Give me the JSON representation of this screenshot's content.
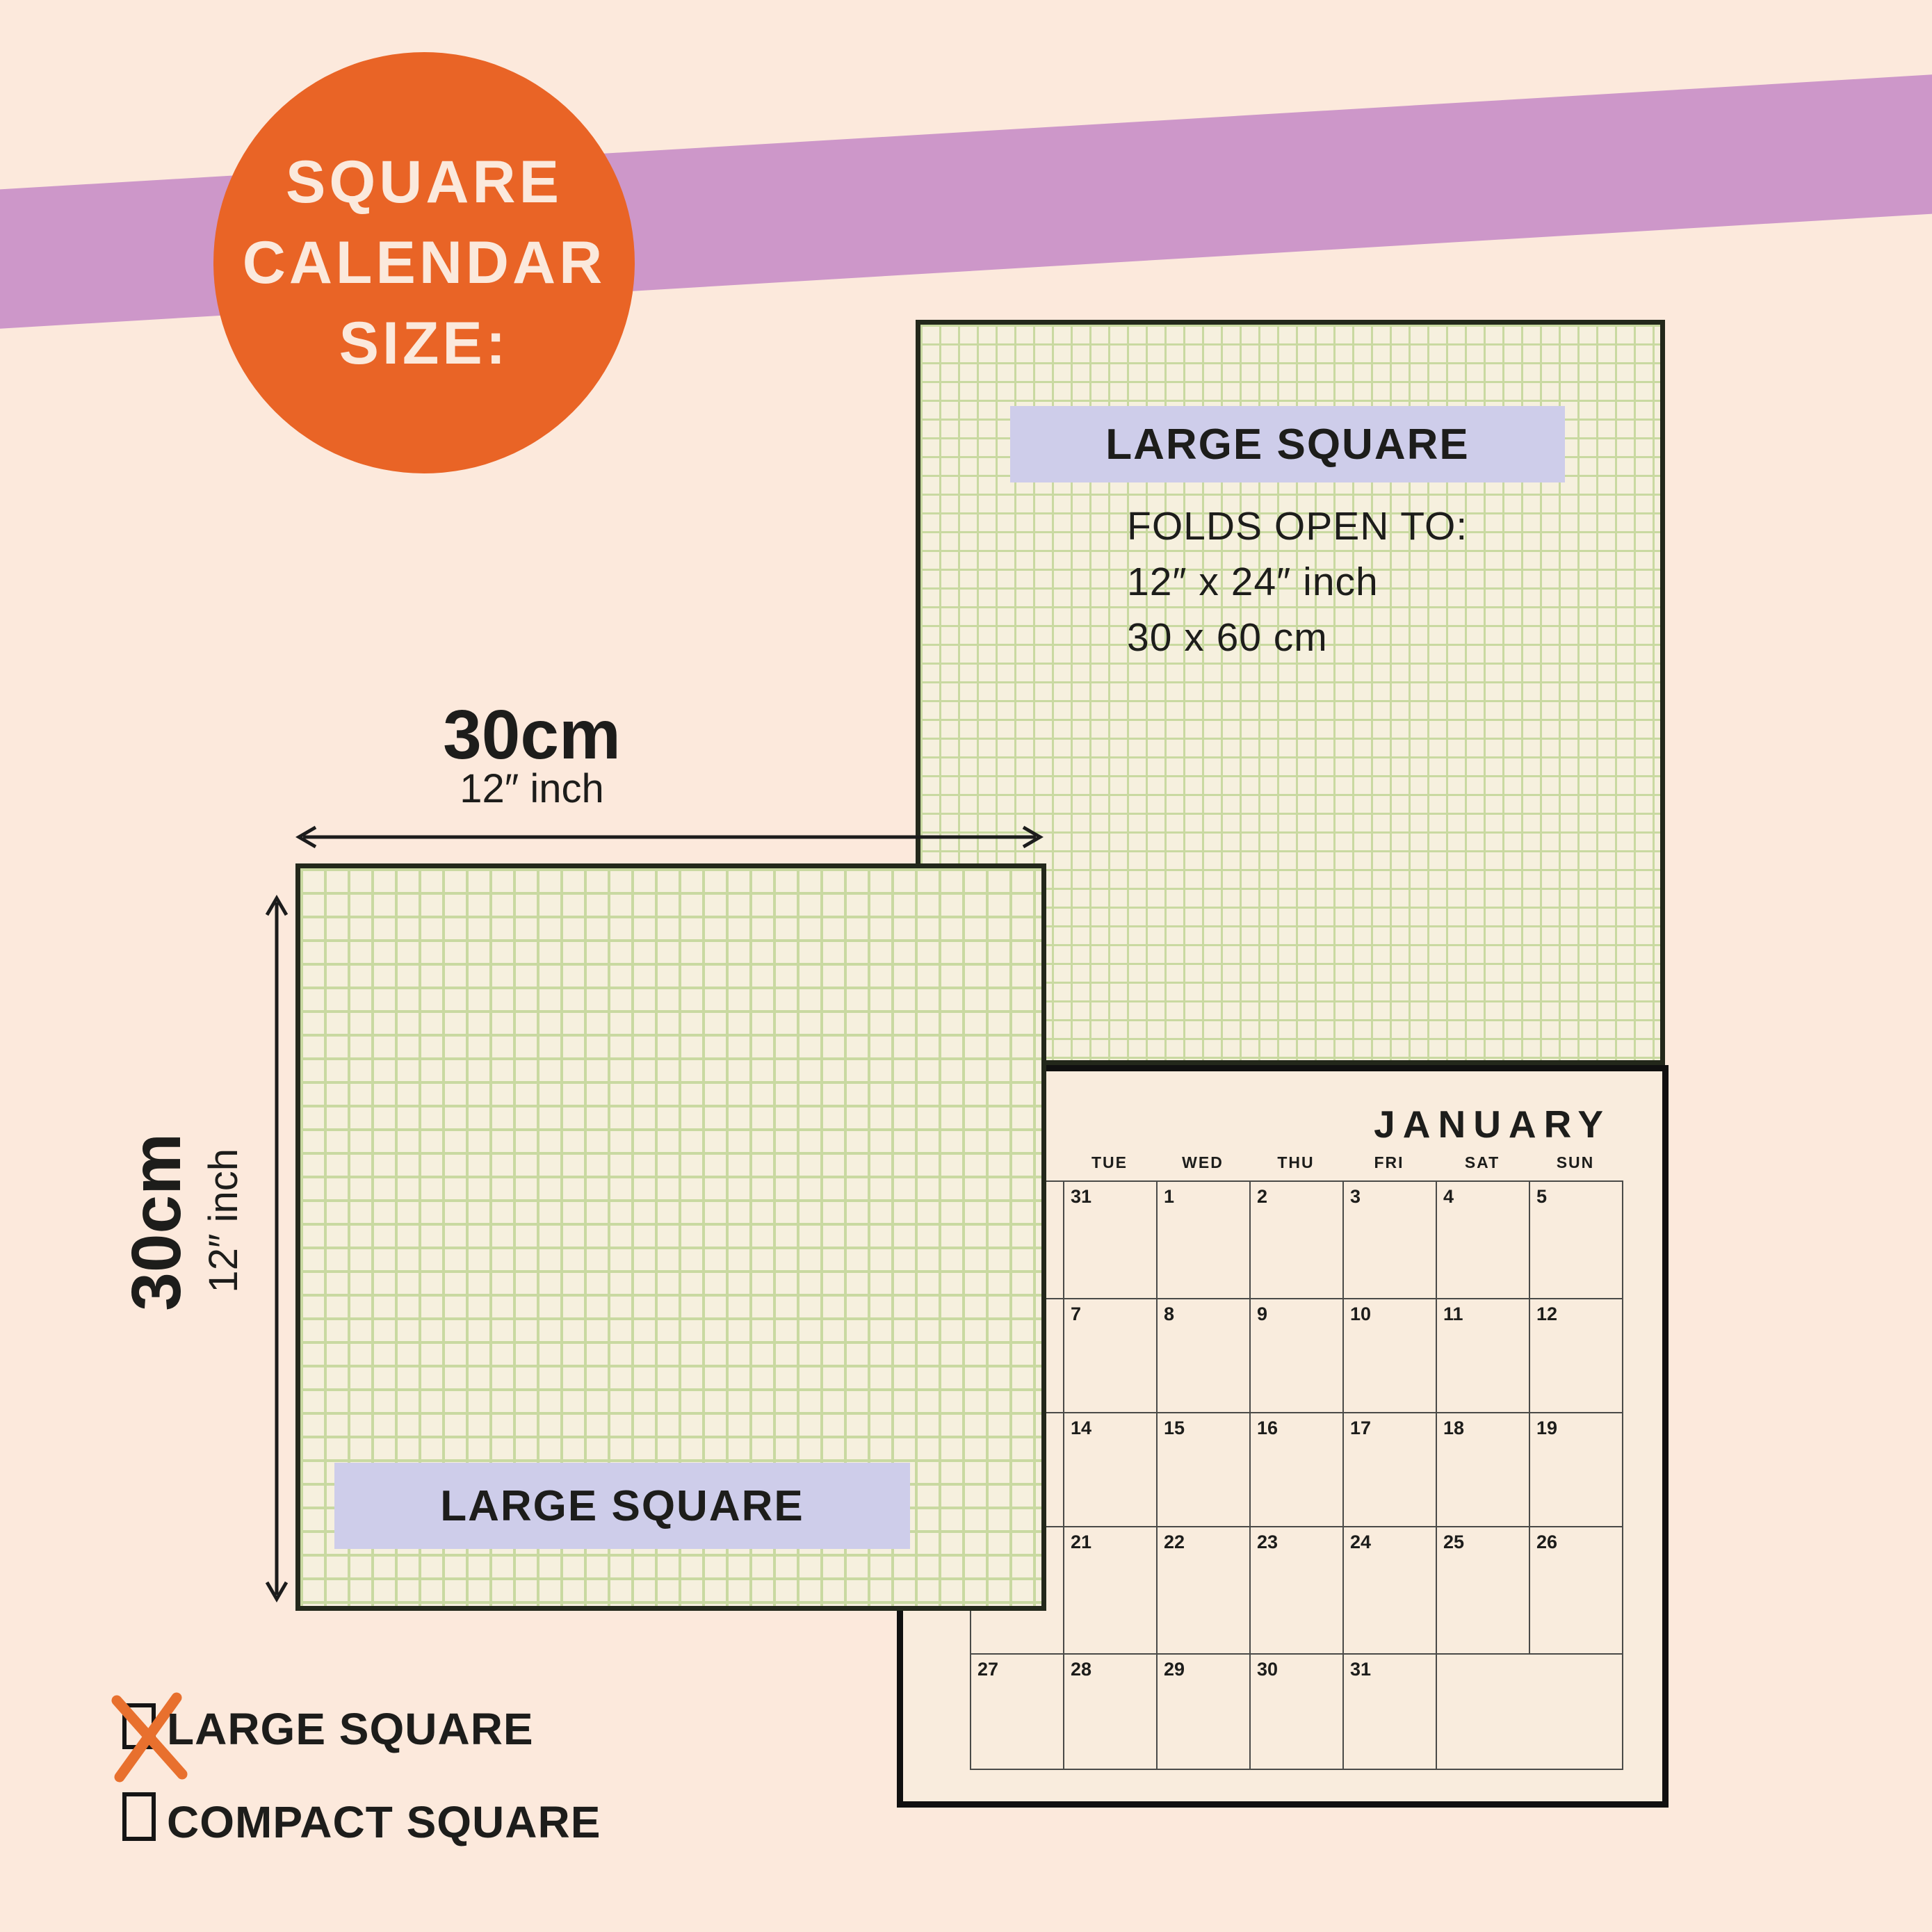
{
  "badge": {
    "line1": "SQUARE",
    "line2": "CALENDAR",
    "line3": "SIZE:"
  },
  "top_square": {
    "label": "LARGE SQUARE",
    "folds_title": "FOLDS OPEN TO:",
    "folds_line1": "12″ x 24″ inch",
    "folds_line2": "30 x 60 cm"
  },
  "left_square": {
    "label": "LARGE SQUARE"
  },
  "dimensions": {
    "horizontal": {
      "primary": "30cm",
      "secondary": "12″ inch"
    },
    "vertical": {
      "primary": "30cm",
      "secondary": "12″ inch"
    }
  },
  "calendar": {
    "month": "JANUARY",
    "day_names": [
      "",
      "TUE",
      "WED",
      "THU",
      "FRI",
      "SAT",
      "SUN"
    ],
    "rows": [
      [
        "",
        "31",
        "1",
        "2",
        "3",
        "4",
        "5"
      ],
      [
        "",
        "7",
        "8",
        "9",
        "10",
        "11",
        "12"
      ],
      [
        "",
        "14",
        "15",
        "16",
        "17",
        "18",
        "19"
      ],
      [
        "",
        "21",
        "22",
        "23",
        "24",
        "25",
        "26"
      ],
      [
        "27",
        "28",
        "29",
        "30",
        "31",
        ""
      ]
    ]
  },
  "options": [
    {
      "label": "LARGE SQUARE",
      "checked": true
    },
    {
      "label": "COMPACT SQUARE",
      "checked": false
    }
  ],
  "colors": {
    "background": "#fce9dc",
    "band": "#cd97c9",
    "accent_orange": "#e96426",
    "grid_paper": "#f6f0de",
    "grid_line": "#c9d9a1",
    "label_lavender": "#cecdea",
    "ink": "#1d1d1b"
  }
}
